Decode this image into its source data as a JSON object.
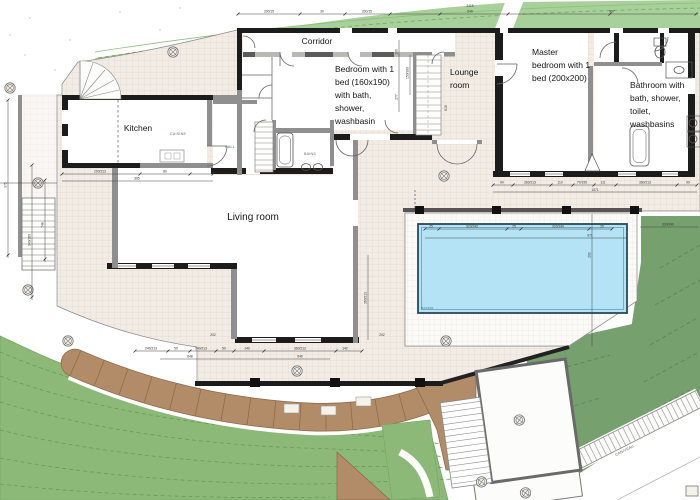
{
  "labels": {
    "corridor": "Corridor",
    "kitchen": "Kitchen",
    "living": "Living room",
    "lounge": [
      "Lounge",
      "room"
    ],
    "bedroom": [
      "Bedroom with 1",
      "bed (160x190)",
      "with bath,",
      "shower,",
      "washbasin"
    ],
    "master": [
      "Master",
      "bedroom with 1",
      "bed (200x200)"
    ],
    "bathroom": [
      "Bathroom with",
      "bath, shower,",
      "toilet,",
      "washbasins"
    ]
  },
  "annotations": {
    "bains": "BAINS",
    "cuisine": "CUISINE",
    "hall": "HALL",
    "bassin": "BASSIN",
    "caniveau": "CANIVEAU"
  },
  "dims": {
    "top": [
      "200/15",
      "30",
      "200/15",
      "2415",
      "640",
      "907"
    ],
    "pool": [
      "25",
      "320/240",
      "25",
      "320/240",
      "25",
      "971",
      "320/240"
    ],
    "south": [
      "240/213",
      "50",
      "240/213",
      "50",
      "140",
      "360/212",
      "142",
      "648",
      "640",
      "202",
      "202"
    ],
    "master": [
      "90",
      "360/213",
      "110",
      "70/195",
      "111",
      "360/213",
      "90",
      "1071"
    ],
    "kitchen": [
      "200/213",
      "80",
      "365"
    ],
    "left": [
      "375",
      "340/160",
      "748"
    ],
    "lounge": [
      "100",
      "277",
      "610",
      "150/300"
    ],
    "living": [
      "360/213",
      "202"
    ]
  },
  "colors": {
    "band_green": "#a8d09a",
    "hill_green": "#8cb978",
    "dark_green": "#76a06e",
    "earth_brown": "#b28c68",
    "pool_blue": "#b3e3f5",
    "tile": "#f2ece5",
    "wall_dark": "#1c1c1c",
    "wall_gray": "#8f8f8f"
  }
}
